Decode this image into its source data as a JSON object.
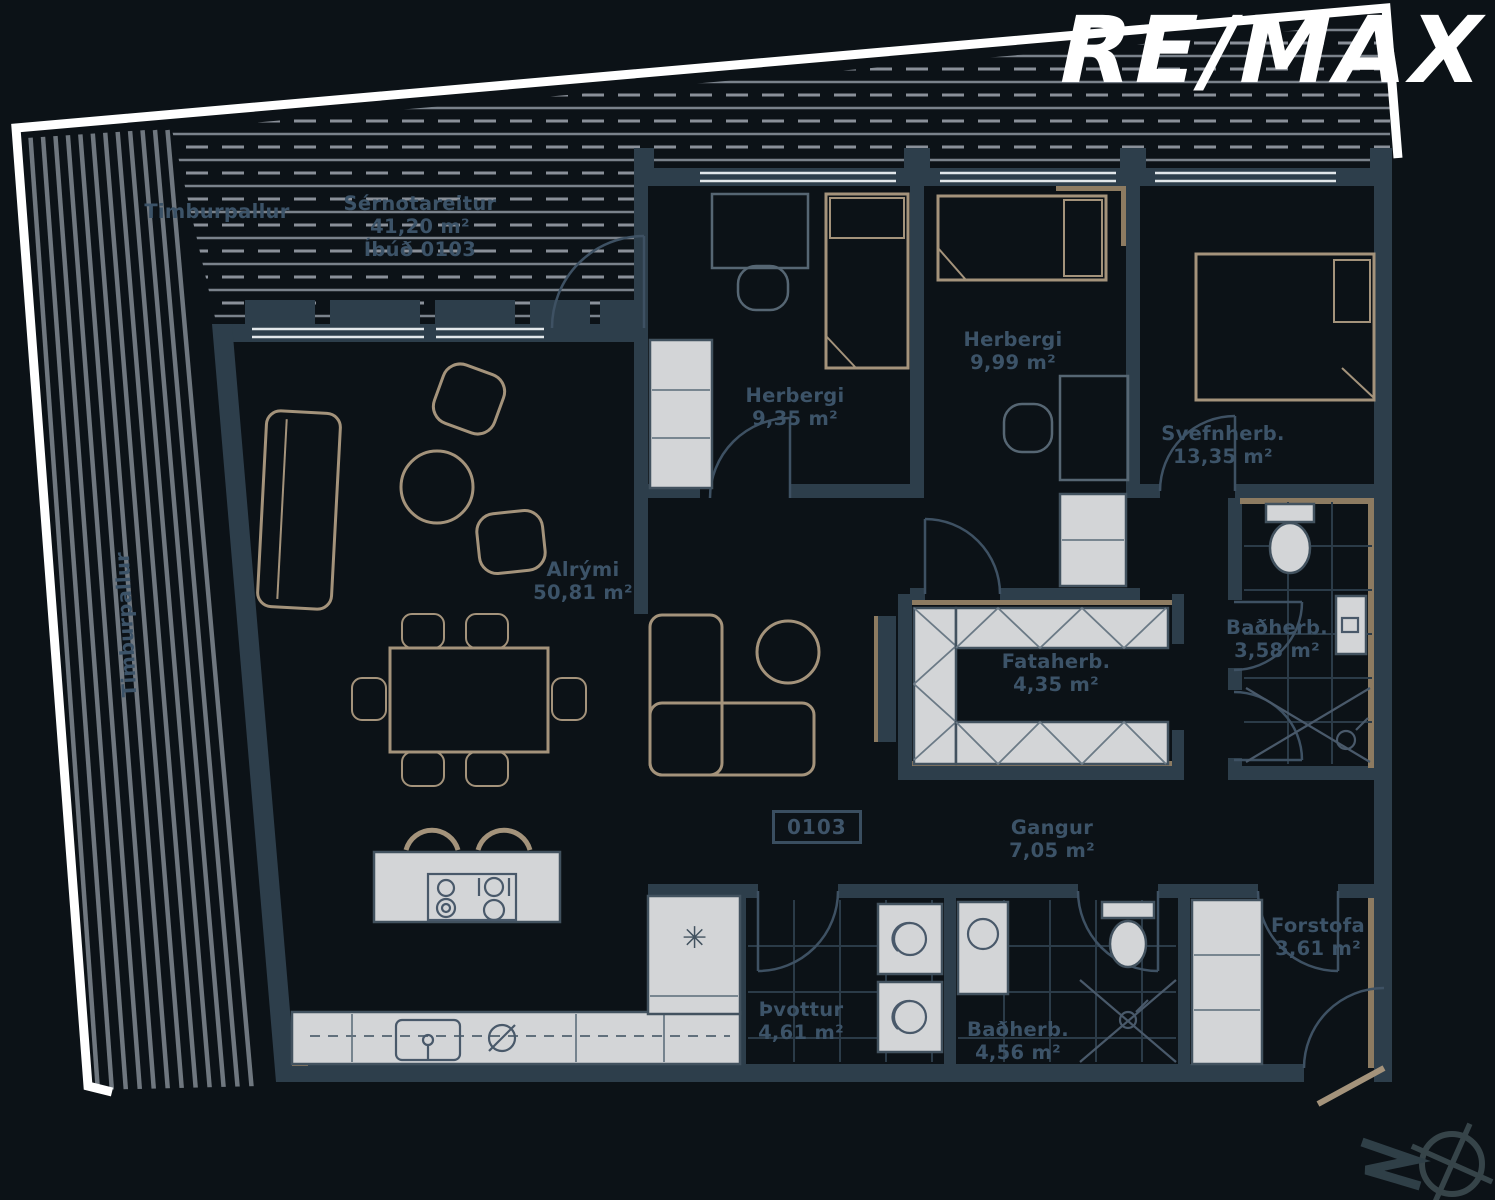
{
  "logo": {
    "brand": "RE/MAX"
  },
  "unit": {
    "badge": "0103"
  },
  "labels": {
    "sernotareitur": {
      "name": "Sérnotareitur",
      "area": "41,20 m²",
      "unit": "Íbúð 0103"
    },
    "timburpallur_top": {
      "name": "Timburpallur"
    },
    "timburpallur_left": {
      "name": "Timburpallur"
    },
    "herbergi1": {
      "name": "Herbergi",
      "area": "9,35 m²"
    },
    "herbergi2": {
      "name": "Herbergi",
      "area": "9,99 m²"
    },
    "svefnherb": {
      "name": "Svefnherb.",
      "area": "13,35 m²"
    },
    "alrymi": {
      "name": "Alrými",
      "area": "50,81 m²"
    },
    "fataherb": {
      "name": "Fataherb.",
      "area": "4,35 m²"
    },
    "badherb1": {
      "name": "Baðherb.",
      "area": "3,58 m²"
    },
    "gangur": {
      "name": "Gangur",
      "area": "7,05 m²"
    },
    "thvottur": {
      "name": "Þvottur",
      "area": "4,61 m²"
    },
    "badherb2": {
      "name": "Baðherb.",
      "area": "4,56 m²"
    },
    "forstofa": {
      "name": "Forstofa",
      "area": "3,61 m²"
    }
  },
  "colors": {
    "background": "#0c1217",
    "wall": "#2d3e4b",
    "wood_accent": "#a4937b",
    "label_text": "#3c5368",
    "fixture_fill": "#d3d5d7",
    "boundary": "#ffffff",
    "logo_text": "#ffffff"
  },
  "icons": {
    "compass": "compass-north-icon"
  }
}
